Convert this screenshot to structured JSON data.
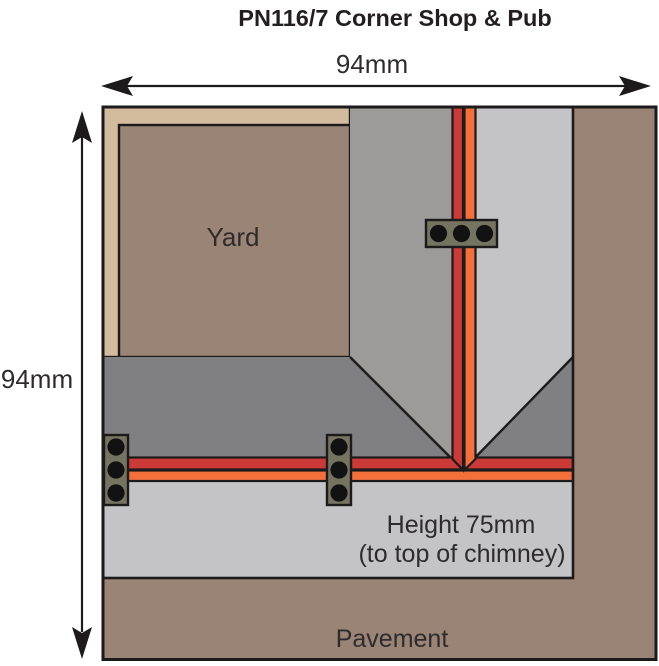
{
  "title": "PN116/7 Corner Shop & Pub",
  "dimensions": {
    "width_label": "94mm",
    "height_label": "94mm"
  },
  "plan": {
    "yard_label": "Yard",
    "height_note_line1": "Height 75mm",
    "height_note_line2": "(to top of chimney)",
    "pavement_label": "Pavement"
  },
  "colors": {
    "background": "#ffffff",
    "outline": "#1c1a1b",
    "text": "#2e2b2c",
    "title_text": "#231f20",
    "pavement_brown": "#9a8475",
    "yard_brown": "#9a8475",
    "wall_tan": "#d3bb9d",
    "roof_dark_gray": "#808082",
    "roof_medium_gray": "#9c9b99",
    "roof_light_gray": "#c4c3c5",
    "ridge_red": "#cb3a36",
    "ridge_orange": "#f3703a",
    "chimney_olive": "#757460",
    "chimney_pot_black": "#121212"
  }
}
